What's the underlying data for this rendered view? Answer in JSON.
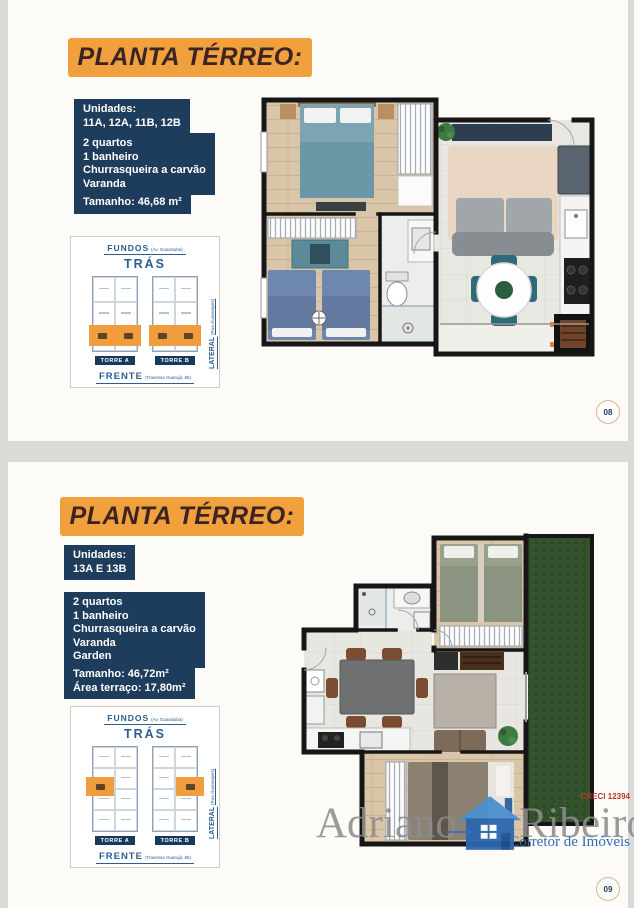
{
  "brand": {
    "watermark_first": "Adriano",
    "watermark_last": "Ribeiro",
    "creci": "CRECI 12394",
    "tagline": "Corretor de Imóveis"
  },
  "colors": {
    "banner_orange": "#f0a03d",
    "info_navy": "#1e3c5b",
    "banner_text": "#3c2422",
    "highlight_orange": "#f09d3f",
    "sitemap_blue": "#2c5d8c",
    "watermark_gray": "#8d8d8d",
    "tagline_blue": "#2e6db4",
    "creci_red": "#b9362b",
    "page_ring_tan": "#d9b78c"
  },
  "panels": [
    {
      "title": "PLANTA TÉRREO:",
      "page_number": "08",
      "units_label": "Unidades:",
      "units_value": "11A, 12A, 11B, 12B",
      "features": [
        "2 quartos",
        "1 banheiro",
        "Churrasqueira a carvão",
        "Varanda"
      ],
      "sizes": [
        "Tamanho: 46,68 m²"
      ],
      "sitemap": {
        "fundos": "FUNDOS",
        "fundos_street": "(Av. Guaratuba)",
        "tras": "TRÁS",
        "lateral": "LATERAL",
        "lateral_street": "(Rua Guararapes)",
        "frente": "FRENTE",
        "frente_street": "(Travessa Guarujá, 85)",
        "tower_a": "TORRE A",
        "tower_b": "TORRE B"
      }
    },
    {
      "title": "PLANTA TÉRREO:",
      "page_number": "09",
      "units_label": "Unidades:",
      "units_value": "13A E 13B",
      "features": [
        "2 quartos",
        "1 banheiro",
        "Churrasqueira a carvão",
        "Varanda",
        "Garden"
      ],
      "sizes": [
        "Tamanho: 46,72m²",
        "Área terraço:  17,80m²"
      ],
      "sitemap": {
        "fundos": "FUNDOS",
        "fundos_street": "(Av. Guaratuba)",
        "tras": "TRÁS",
        "lateral": "LATERAL",
        "lateral_street": "(Rua Guararapes)",
        "frente": "FRENTE",
        "frente_street": "(Travessa Guarujá, 85)",
        "tower_a": "TORRE A",
        "tower_b": "TORRE B"
      }
    }
  ]
}
